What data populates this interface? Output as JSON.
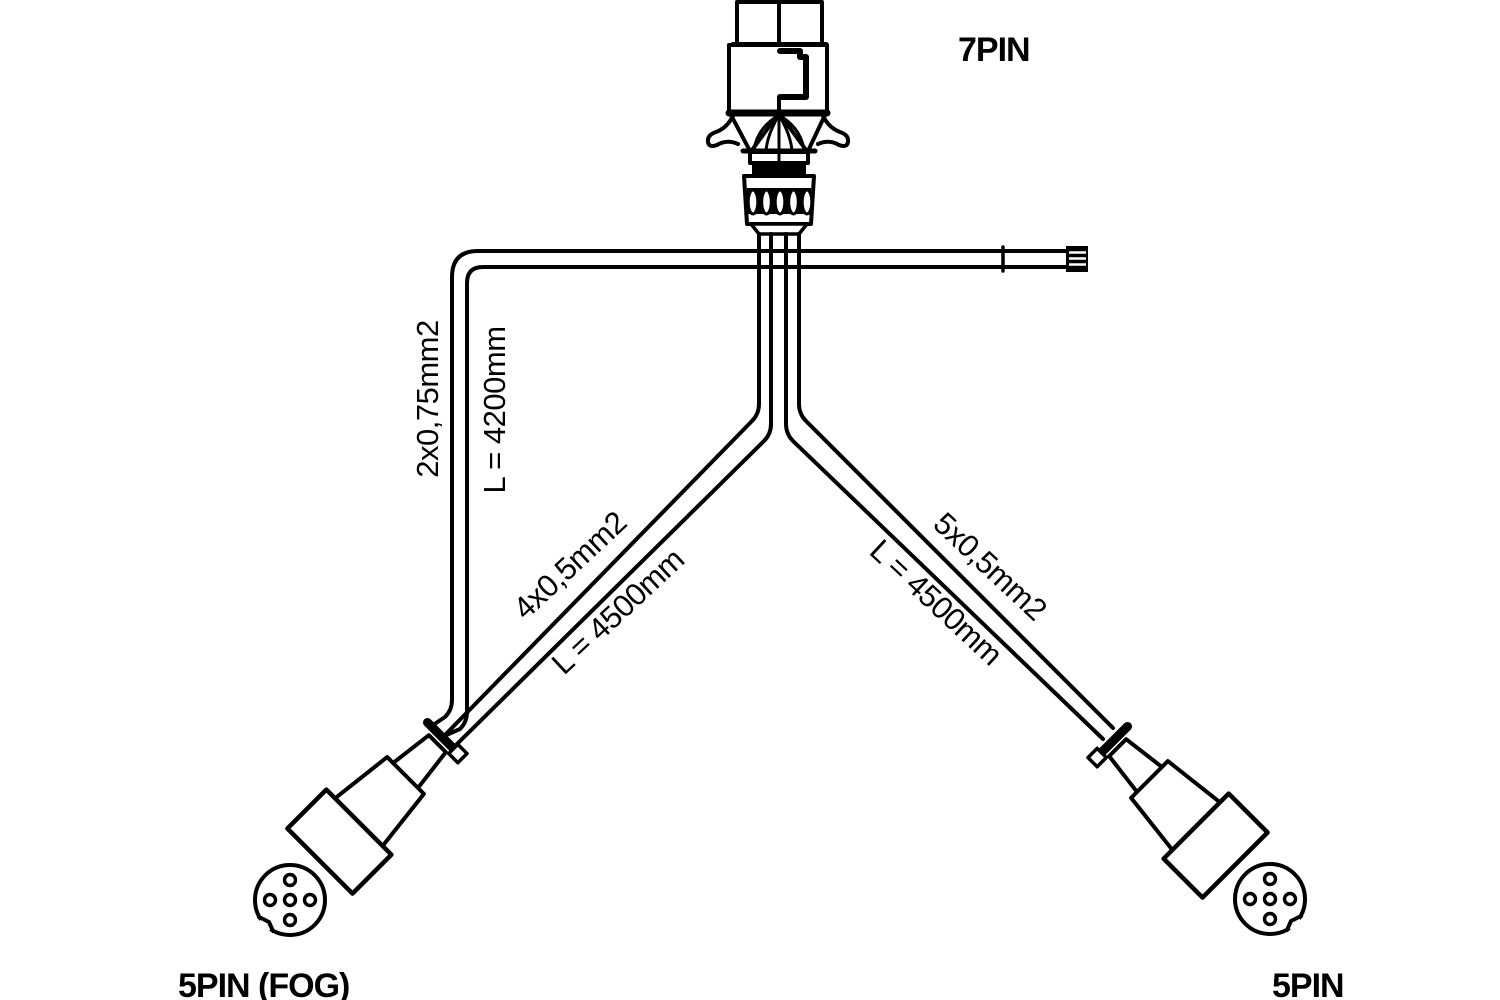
{
  "page": {
    "background": "#ffffff",
    "line_color": "#000000"
  },
  "connectors": {
    "top": {
      "label": "7PIN"
    },
    "bottom_left": {
      "label": "5PIN (FOG)"
    },
    "bottom_right": {
      "label": "5PIN"
    }
  },
  "cables": {
    "fog_branch": {
      "spec": "2x0,75mm2",
      "length": "L = 4200mm"
    },
    "left_branch": {
      "spec": "4x0,5mm2",
      "length": "L = 4500mm"
    },
    "right_branch": {
      "spec": "5x0,5mm2",
      "length": "L = 4500mm"
    }
  }
}
